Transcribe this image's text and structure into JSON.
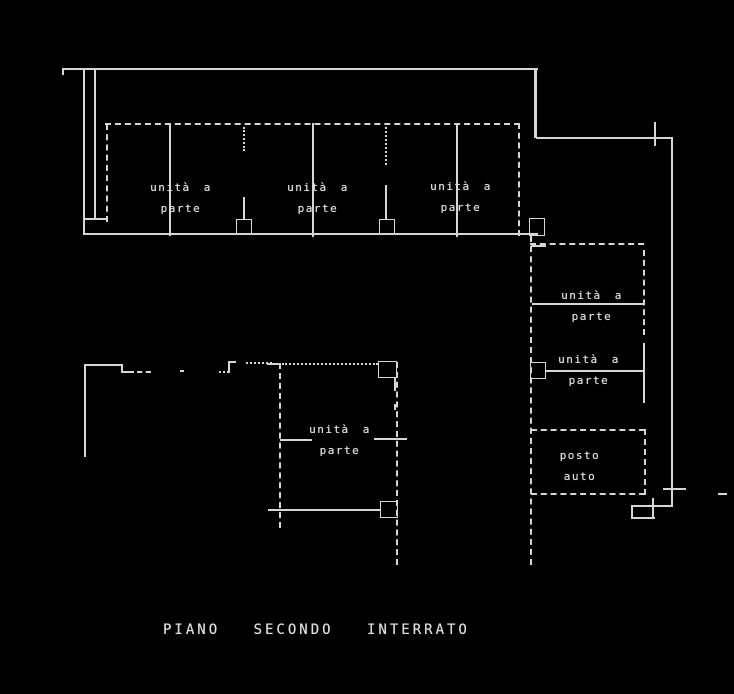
{
  "canvas": {
    "width": 734,
    "height": 694,
    "background": "#000000",
    "line_color": "#d6d6d6",
    "text_color": "#dedede"
  },
  "caption": {
    "text": "PIANO SECONDO INTERRATO",
    "x": 163,
    "y": 622
  },
  "labels": [
    {
      "x": 181,
      "y": 177,
      "lines": [
        "unità a",
        "parte"
      ]
    },
    {
      "x": 318,
      "y": 177,
      "lines": [
        "unità a",
        "parte"
      ]
    },
    {
      "x": 461,
      "y": 176,
      "lines": [
        "unità a",
        "parte"
      ]
    },
    {
      "x": 592,
      "y": 285,
      "lines": [
        "unità a",
        "parte"
      ]
    },
    {
      "x": 589,
      "y": 349,
      "lines": [
        "unità a",
        "parte"
      ]
    },
    {
      "x": 340,
      "y": 419,
      "lines": [
        "unità a",
        "parte"
      ]
    },
    {
      "x": 580,
      "y": 445,
      "lines": [
        "posto",
        "auto"
      ]
    }
  ],
  "walls": [
    {
      "x": 62,
      "y": 68,
      "w": 476,
      "h": 2,
      "s": "solid"
    },
    {
      "x": 62,
      "y": 68,
      "w": 2,
      "h": 7,
      "s": "solid"
    },
    {
      "x": 83,
      "y": 68,
      "w": 2,
      "h": 167,
      "s": "solid"
    },
    {
      "x": 94,
      "y": 70,
      "w": 1.5,
      "h": 148,
      "s": "solid"
    },
    {
      "x": 84,
      "y": 218,
      "w": 24,
      "h": 1.5,
      "s": "solid"
    },
    {
      "x": 84,
      "y": 233,
      "w": 454,
      "h": 2,
      "s": "solid"
    },
    {
      "x": 534,
      "y": 69,
      "w": 3,
      "h": 69,
      "s": "solid"
    },
    {
      "x": 536,
      "y": 137,
      "w": 137,
      "h": 2,
      "s": "solid"
    },
    {
      "x": 671,
      "y": 139,
      "w": 2,
      "h": 368,
      "s": "solid"
    },
    {
      "x": 631,
      "y": 505,
      "w": 42,
      "h": 2,
      "s": "solid"
    },
    {
      "x": 631,
      "y": 506,
      "w": 1.5,
      "h": 12,
      "s": "solid"
    },
    {
      "x": 631,
      "y": 517,
      "w": 24,
      "h": 1.5,
      "s": "solid"
    },
    {
      "x": 105,
      "y": 123,
      "w": 415,
      "h": 2,
      "s": "dashed"
    },
    {
      "x": 106,
      "y": 124,
      "w": 2,
      "h": 98,
      "s": "dashed"
    },
    {
      "x": 169,
      "y": 123,
      "w": 1.5,
      "h": 113,
      "s": "solid"
    },
    {
      "x": 243,
      "y": 127,
      "w": 2,
      "h": 24,
      "s": "dotted"
    },
    {
      "x": 243,
      "y": 197,
      "w": 1.5,
      "h": 23,
      "s": "solid"
    },
    {
      "x": 312,
      "y": 123,
      "w": 1.5,
      "h": 114,
      "s": "solid"
    },
    {
      "x": 385,
      "y": 123,
      "w": 2,
      "h": 42,
      "s": "dotted"
    },
    {
      "x": 385,
      "y": 185,
      "w": 1.5,
      "h": 35,
      "s": "solid"
    },
    {
      "x": 456,
      "y": 123,
      "w": 1.5,
      "h": 114,
      "s": "solid"
    },
    {
      "x": 518,
      "y": 123,
      "w": 2,
      "h": 113,
      "s": "dashed"
    },
    {
      "x": 530,
      "y": 236,
      "w": 2,
      "h": 329,
      "s": "dashed"
    },
    {
      "x": 531,
      "y": 245,
      "w": 15,
      "h": 1.5,
      "s": "solid"
    },
    {
      "x": 530,
      "y": 243,
      "w": 114,
      "h": 2,
      "s": "dashed"
    },
    {
      "x": 643,
      "y": 250,
      "w": 2,
      "h": 85,
      "s": "dashed"
    },
    {
      "x": 532,
      "y": 303,
      "w": 111,
      "h": 1.5,
      "s": "solid"
    },
    {
      "x": 643,
      "y": 343,
      "w": 1.5,
      "h": 60,
      "s": "solid"
    },
    {
      "x": 546,
      "y": 370,
      "w": 97,
      "h": 2,
      "s": "solid"
    },
    {
      "x": 531,
      "y": 429,
      "w": 114,
      "h": 2,
      "s": "dashed"
    },
    {
      "x": 644,
      "y": 429,
      "w": 2,
      "h": 66,
      "s": "dashed"
    },
    {
      "x": 531,
      "y": 493,
      "w": 114,
      "h": 2,
      "s": "dashed"
    },
    {
      "x": 267,
      "y": 363,
      "w": 14,
      "h": 1.5,
      "s": "solid"
    },
    {
      "x": 279,
      "y": 363,
      "w": 2,
      "h": 165,
      "s": "dashed"
    },
    {
      "x": 282,
      "y": 363,
      "w": 96,
      "h": 2,
      "s": "dotted"
    },
    {
      "x": 280,
      "y": 439,
      "w": 32,
      "h": 1.5,
      "s": "solid"
    },
    {
      "x": 374,
      "y": 438,
      "w": 33,
      "h": 1.5,
      "s": "solid"
    },
    {
      "x": 396,
      "y": 362,
      "w": 2,
      "h": 203,
      "s": "dashed"
    },
    {
      "x": 268,
      "y": 509,
      "w": 112,
      "h": 1.5,
      "s": "solid"
    },
    {
      "x": 394,
      "y": 378,
      "w": 1.5,
      "h": 13,
      "s": "solid"
    },
    {
      "x": 394,
      "y": 404,
      "w": 1.5,
      "h": 6,
      "s": "solid"
    },
    {
      "x": 84,
      "y": 364,
      "w": 38,
      "h": 1.5,
      "s": "solid"
    },
    {
      "x": 121,
      "y": 364,
      "w": 1.5,
      "h": 9,
      "s": "solid"
    },
    {
      "x": 121,
      "y": 371,
      "w": 13,
      "h": 1.5,
      "s": "solid"
    },
    {
      "x": 137,
      "y": 371,
      "w": 14,
      "h": 2,
      "s": "dashed"
    },
    {
      "x": 180,
      "y": 370,
      "w": 4,
      "h": 2,
      "s": "solid"
    },
    {
      "x": 84,
      "y": 364,
      "w": 1.5,
      "h": 93,
      "s": "solid"
    },
    {
      "x": 219,
      "y": 371,
      "w": 10,
      "h": 2,
      "s": "dotted"
    },
    {
      "x": 228,
      "y": 362,
      "w": 1.5,
      "h": 11,
      "s": "solid"
    },
    {
      "x": 228,
      "y": 361,
      "w": 8,
      "h": 1.5,
      "s": "solid"
    },
    {
      "x": 246,
      "y": 362,
      "w": 26,
      "h": 2,
      "s": "dotted"
    }
  ],
  "ticks": [
    {
      "x": 654,
      "y": 122,
      "w": 1.5,
      "h": 24,
      "s": "solid"
    },
    {
      "x": 652,
      "y": 498,
      "w": 1.5,
      "h": 20,
      "s": "solid"
    },
    {
      "x": 663,
      "y": 488,
      "w": 23,
      "h": 1.5,
      "s": "solid"
    },
    {
      "x": 718,
      "y": 493,
      "w": 9,
      "h": 1.5,
      "s": "solid"
    }
  ],
  "doors": [
    {
      "x": 236,
      "y": 219,
      "w": 16,
      "h": 16
    },
    {
      "x": 379,
      "y": 219,
      "w": 16,
      "h": 16
    },
    {
      "x": 529,
      "y": 218,
      "w": 16,
      "h": 18
    },
    {
      "x": 530,
      "y": 362,
      "w": 16,
      "h": 17
    },
    {
      "x": 380,
      "y": 501,
      "w": 18,
      "h": 17
    },
    {
      "x": 378,
      "y": 361,
      "w": 19,
      "h": 17
    }
  ]
}
